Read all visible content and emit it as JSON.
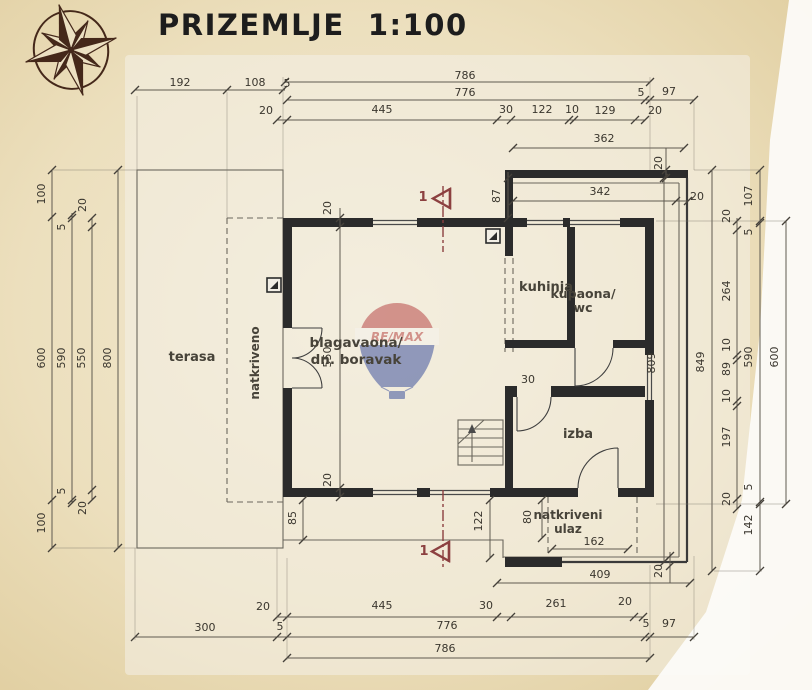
{
  "page": {
    "title": "PRIZEMLJE  1:100"
  },
  "watermark": {
    "brand": "RE/MAX"
  },
  "colors": {
    "paper": "#ecdfbd",
    "paper_edge": "#dfcc9c",
    "plan_bg": "#f4f0e7",
    "wall": "#2b2b2b",
    "dim_text": "#3a362e",
    "section_red": "#8c4040",
    "balloon_red": "#b23a3a",
    "balloon_blue": "#2f4699",
    "compass": "#45281a"
  },
  "plan": {
    "rooms": [
      {
        "t": "terasa",
        "x": 192,
        "y": 361,
        "s": 13
      },
      {
        "t": "natkriveno",
        "x": 259,
        "y": 363,
        "r": -90,
        "s": 12
      },
      {
        "t": "blagavaona/",
        "x": 356,
        "y": 347,
        "s": 13.5,
        "a": "s"
      },
      {
        "t": "dn. boravak",
        "x": 356,
        "y": 364,
        "s": 13.5,
        "a": "s"
      },
      {
        "t": "kuhinja",
        "x": 546,
        "y": 291,
        "s": 13
      },
      {
        "t": "kupaona/",
        "x": 583,
        "y": 298,
        "s": 12.5,
        "a": "s"
      },
      {
        "t": "wc",
        "x": 583,
        "y": 312,
        "s": 12.5,
        "a": "s"
      },
      {
        "t": "izba",
        "x": 578,
        "y": 438,
        "s": 13
      },
      {
        "t": "natkriveni",
        "x": 568,
        "y": 519,
        "s": 12,
        "a": "s"
      },
      {
        "t": "ulaz",
        "x": 568,
        "y": 533,
        "s": 12,
        "a": "s"
      }
    ],
    "dims": [
      {
        "t": "786",
        "x": 465,
        "y": 79
      },
      {
        "t": "776",
        "x": 465,
        "y": 96
      },
      {
        "t": "5",
        "x": 641,
        "y": 96
      },
      {
        "t": "97",
        "x": 669,
        "y": 95
      },
      {
        "t": "192",
        "x": 180,
        "y": 86
      },
      {
        "t": "108",
        "x": 255,
        "y": 86
      },
      {
        "t": "5",
        "x": 287,
        "y": 87
      },
      {
        "t": "20",
        "x": 266,
        "y": 114
      },
      {
        "t": "445",
        "x": 382,
        "y": 113
      },
      {
        "t": "30",
        "x": 506,
        "y": 113
      },
      {
        "t": "122",
        "x": 542,
        "y": 113
      },
      {
        "t": "10",
        "x": 572,
        "y": 113
      },
      {
        "t": "129",
        "x": 605,
        "y": 114
      },
      {
        "t": "20",
        "x": 655,
        "y": 114
      },
      {
        "t": "362",
        "x": 604,
        "y": 142
      },
      {
        "t": "20",
        "x": 662,
        "y": 163,
        "r": -90
      },
      {
        "t": "342",
        "x": 600,
        "y": 195
      },
      {
        "t": "20",
        "x": 697,
        "y": 200
      },
      {
        "t": "87",
        "x": 500,
        "y": 196,
        "r": -90
      },
      {
        "t": "100",
        "x": 45,
        "y": 194,
        "r": -90
      },
      {
        "t": "20",
        "x": 86,
        "y": 205,
        "r": -90
      },
      {
        "t": "5",
        "x": 65,
        "y": 227,
        "r": -90
      },
      {
        "t": "600",
        "x": 45,
        "y": 358,
        "r": -90
      },
      {
        "t": "590",
        "x": 65,
        "y": 358,
        "r": -90
      },
      {
        "t": "550",
        "x": 85,
        "y": 358,
        "r": -90
      },
      {
        "t": "800",
        "x": 111,
        "y": 358,
        "r": -90
      },
      {
        "t": "5",
        "x": 65,
        "y": 491,
        "r": -90
      },
      {
        "t": "20",
        "x": 86,
        "y": 508,
        "r": -90
      },
      {
        "t": "100",
        "x": 45,
        "y": 523,
        "r": -90
      },
      {
        "t": "20",
        "x": 331,
        "y": 208,
        "r": -90
      },
      {
        "t": "550",
        "x": 331,
        "y": 357,
        "r": -90
      },
      {
        "t": "20",
        "x": 331,
        "y": 480,
        "r": -90
      },
      {
        "t": "30",
        "x": 528,
        "y": 383
      },
      {
        "t": "809",
        "x": 655,
        "y": 363,
        "r": -90
      },
      {
        "t": "849",
        "x": 704,
        "y": 362,
        "r": -90
      },
      {
        "t": "20",
        "x": 730,
        "y": 216,
        "r": -90
      },
      {
        "t": "264",
        "x": 730,
        "y": 291,
        "r": -90
      },
      {
        "t": "10",
        "x": 730,
        "y": 345,
        "r": -90
      },
      {
        "t": "89",
        "x": 730,
        "y": 369,
        "r": -90
      },
      {
        "t": "10",
        "x": 730,
        "y": 396,
        "r": -90
      },
      {
        "t": "197",
        "x": 730,
        "y": 437,
        "r": -90
      },
      {
        "t": "20",
        "x": 730,
        "y": 499,
        "r": -90
      },
      {
        "t": "107",
        "x": 752,
        "y": 196,
        "r": -90
      },
      {
        "t": "5",
        "x": 752,
        "y": 232,
        "r": -90
      },
      {
        "t": "590",
        "x": 752,
        "y": 357,
        "r": -90
      },
      {
        "t": "5",
        "x": 752,
        "y": 487,
        "r": -90
      },
      {
        "t": "142",
        "x": 752,
        "y": 525,
        "r": -90
      },
      {
        "t": "600",
        "x": 778,
        "y": 357,
        "r": -90
      },
      {
        "t": "85",
        "x": 296,
        "y": 518,
        "r": -90
      },
      {
        "t": "122",
        "x": 482,
        "y": 521,
        "r": -90
      },
      {
        "t": "80",
        "x": 531,
        "y": 517,
        "r": -90
      },
      {
        "t": "162",
        "x": 594,
        "y": 545
      },
      {
        "t": "409",
        "x": 600,
        "y": 578
      },
      {
        "t": "20",
        "x": 662,
        "y": 571,
        "r": -90
      },
      {
        "t": "20",
        "x": 263,
        "y": 610
      },
      {
        "t": "445",
        "x": 382,
        "y": 609
      },
      {
        "t": "30",
        "x": 486,
        "y": 609
      },
      {
        "t": "261",
        "x": 556,
        "y": 607
      },
      {
        "t": "20",
        "x": 625,
        "y": 605
      },
      {
        "t": "300",
        "x": 205,
        "y": 631
      },
      {
        "t": "5",
        "x": 280,
        "y": 630
      },
      {
        "t": "776",
        "x": 447,
        "y": 629
      },
      {
        "t": "5",
        "x": 646,
        "y": 627
      },
      {
        "t": "97",
        "x": 669,
        "y": 627
      },
      {
        "t": "786",
        "x": 445,
        "y": 652
      }
    ],
    "markers": [
      {
        "t": "1",
        "x": 423,
        "y": 201
      },
      {
        "t": "1",
        "x": 424,
        "y": 555
      }
    ]
  }
}
